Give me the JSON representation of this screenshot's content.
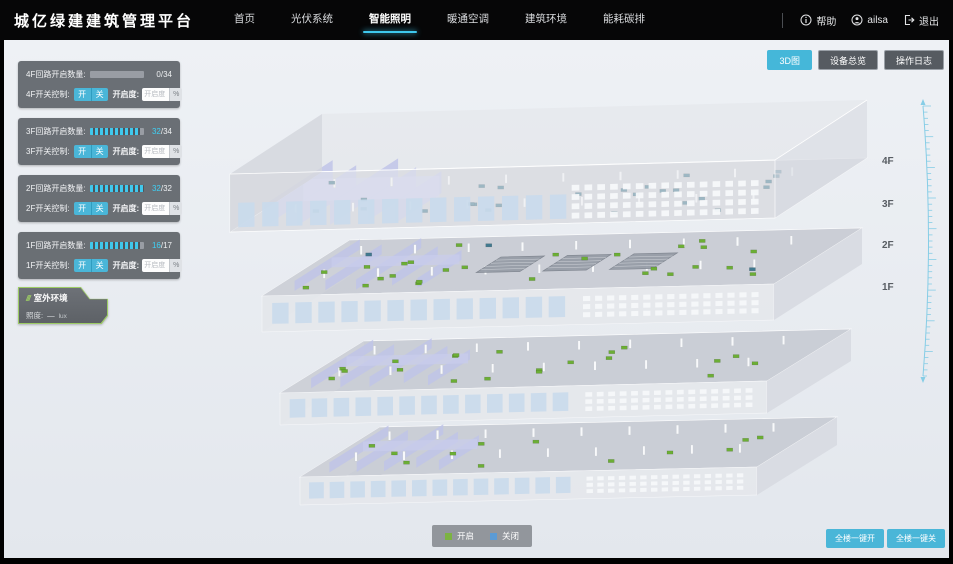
{
  "header": {
    "title": "城亿绿建建筑管理平台",
    "nav": [
      {
        "label": "首页"
      },
      {
        "label": "光伏系统"
      },
      {
        "label": "智能照明"
      },
      {
        "label": "暖通空调"
      },
      {
        "label": "建筑环境"
      },
      {
        "label": "能耗碳排"
      }
    ],
    "help_label": "帮助",
    "username": "ailsa",
    "logout_label": "退出"
  },
  "toolbar": {
    "view_3d": "3D图",
    "device_overview": "设备总览",
    "operation_log": "操作日志"
  },
  "floor_panels": [
    {
      "count_label": "4F回路开启数量:",
      "count_on": "0",
      "count_total": "/34",
      "progress": 0,
      "switch_label": "4F开关控制:",
      "on_label": "开",
      "off_label": "关",
      "dim_label": "开启度:",
      "dim_placeholder": "开启度",
      "percent_label": "%"
    },
    {
      "count_label": "3F回路开启数量:",
      "count_on": "32",
      "count_total": "/34",
      "progress": 94,
      "switch_label": "3F开关控制:",
      "on_label": "开",
      "off_label": "关",
      "dim_label": "开启度:",
      "dim_placeholder": "开启度",
      "percent_label": "%"
    },
    {
      "count_label": "2F回路开启数量:",
      "count_on": "32",
      "count_total": "/32",
      "progress": 100,
      "switch_label": "2F开关控制:",
      "on_label": "开",
      "off_label": "关",
      "dim_label": "开启度:",
      "dim_placeholder": "开启度",
      "percent_label": "%"
    },
    {
      "count_label": "1F回路开启数量:",
      "count_on": "16",
      "count_total": "/17",
      "progress": 94,
      "switch_label": "1F开关控制:",
      "on_label": "开",
      "off_label": "关",
      "dim_label": "开启度:",
      "dim_placeholder": "开启度",
      "percent_label": "%"
    }
  ],
  "outdoor_panel": {
    "title": "室外环境",
    "metric_label": "照度:",
    "metric_value": "—",
    "metric_unit": "lux"
  },
  "floor_labels": [
    "4F",
    "3F",
    "2F",
    "1F"
  ],
  "legend": {
    "on": {
      "label": "开启",
      "color": "#7cb342"
    },
    "off": {
      "label": "关闭",
      "color": "#5b9bd5"
    }
  },
  "bulk_controls": {
    "all_on": "全楼一键开",
    "all_off": "全楼一键关"
  },
  "colors": {
    "accent": "#45b7d9",
    "nav_active_underline": "#3fc8ee",
    "marker_on": "#6cae35",
    "marker_off": "#41798f"
  }
}
